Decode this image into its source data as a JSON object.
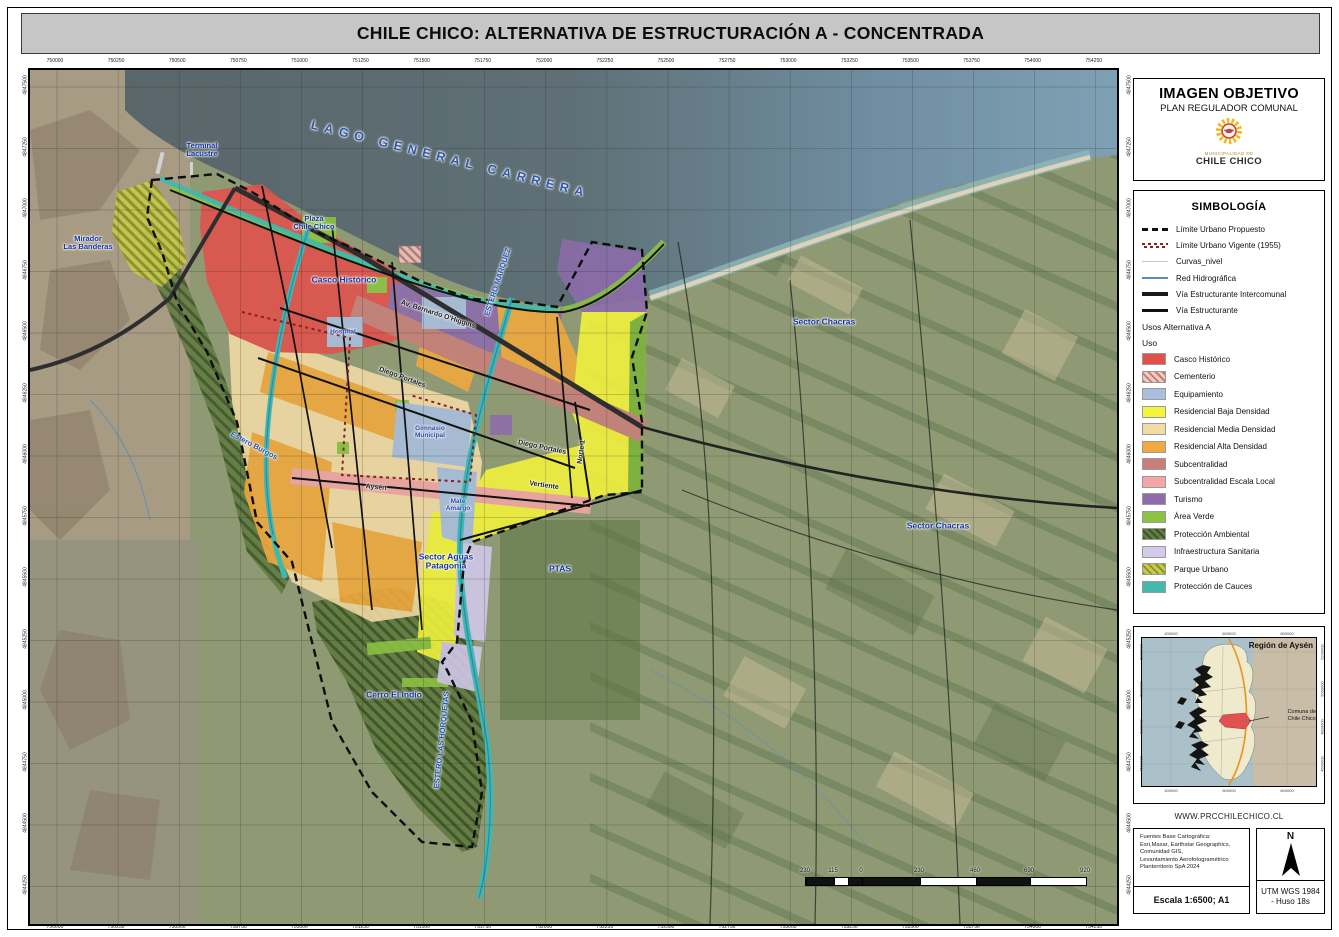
{
  "title": "CHILE CHICO: ALTERNATIVA DE ESTRUCTURACIÓN A - CONCENTRADA",
  "map": {
    "top_ticks": [
      "750000",
      "750250",
      "750500",
      "750750",
      "751000",
      "751250",
      "751500",
      "751750",
      "752000",
      "752250",
      "752500",
      "752750",
      "753000",
      "753250",
      "753500",
      "753750",
      "754000",
      "754250"
    ],
    "bottom_ticks": [
      "750000",
      "750250",
      "750500",
      "750750",
      "751000",
      "751250",
      "751500",
      "751750",
      "752000",
      "752250",
      "752500",
      "752750",
      "753000",
      "753250",
      "753500",
      "753750",
      "754000",
      "754250"
    ],
    "left_ticks": [
      "4847500",
      "4847250",
      "4847000",
      "4846750",
      "4846500",
      "4846250",
      "4846000",
      "4845750",
      "4845500",
      "4845250",
      "4845000",
      "4844750",
      "4844500",
      "4844250"
    ],
    "right_ticks": [
      "4847500",
      "4847250",
      "4847000",
      "4846750",
      "4846500",
      "4846250",
      "4846000",
      "4845750",
      "4845500",
      "4845250",
      "4845000",
      "4844750",
      "4844500",
      "4844250"
    ],
    "scalebar": {
      "labels": [
        "230",
        "115",
        "0",
        "230",
        "460",
        "690",
        "920"
      ]
    },
    "labels": [
      {
        "t": "LAGO GENERAL CARRERA",
        "x": 420,
        "y": 90,
        "r": 14,
        "c": "lake"
      },
      {
        "t": "Terminal\nLacustre",
        "x": 172,
        "y": 80,
        "r": 0,
        "c": "place sm"
      },
      {
        "t": "Mirador\nLas Banderas",
        "x": 58,
        "y": 173,
        "r": 0,
        "c": "place sm"
      },
      {
        "t": "Plaza\nChile Chico",
        "x": 284,
        "y": 153,
        "r": 0,
        "c": "place sm"
      },
      {
        "t": "Casco Histórico",
        "x": 314,
        "y": 210,
        "r": 0,
        "c": "place"
      },
      {
        "t": "Av. Bernardo O'Higgins",
        "x": 408,
        "y": 245,
        "r": 18,
        "c": "street"
      },
      {
        "t": "Diego Portales",
        "x": 372,
        "y": 308,
        "r": 20,
        "c": "street"
      },
      {
        "t": "Diego Portales",
        "x": 512,
        "y": 378,
        "r": 12,
        "c": "street"
      },
      {
        "t": "ESTERO MARQUEZ",
        "x": 468,
        "y": 212,
        "r": -72,
        "c": "water"
      },
      {
        "t": "ESTERO LAS HORQUETAS",
        "x": 412,
        "y": 670,
        "r": -84,
        "c": "water"
      },
      {
        "t": "Estero Burgos",
        "x": 224,
        "y": 376,
        "r": 28,
        "c": "water"
      },
      {
        "t": "Hospital",
        "x": 313,
        "y": 262,
        "r": 0,
        "c": "tinyp"
      },
      {
        "t": "Gimnasio\nMunicipal",
        "x": 400,
        "y": 362,
        "r": 0,
        "c": "tinyp"
      },
      {
        "t": "Mate\nAmargo",
        "x": 428,
        "y": 435,
        "r": 0,
        "c": "tinyp"
      },
      {
        "t": "Aysén",
        "x": 346,
        "y": 418,
        "r": 5,
        "c": "street"
      },
      {
        "t": "Vertiente",
        "x": 514,
        "y": 416,
        "r": 8,
        "c": "street"
      },
      {
        "t": "Norte 1",
        "x": 552,
        "y": 382,
        "r": -82,
        "c": "street"
      },
      {
        "t": "Sector Chacras",
        "x": 794,
        "y": 252,
        "r": 0,
        "c": "place"
      },
      {
        "t": "Sector Chacras",
        "x": 908,
        "y": 456,
        "r": 0,
        "c": "place"
      },
      {
        "t": "Sector Aguas\nPatagonia",
        "x": 416,
        "y": 492,
        "r": 0,
        "c": "place"
      },
      {
        "t": "PTAS",
        "x": 530,
        "y": 499,
        "r": 0,
        "c": "place"
      },
      {
        "t": "Cerro El Indio",
        "x": 364,
        "y": 625,
        "r": 0,
        "c": "place"
      }
    ]
  },
  "panel": {
    "header": {
      "title": "IMAGEN OBJETIVO",
      "subtitle": "PLAN REGULADOR COMUNAL",
      "logo_caption_small": "MUNICIPALIDAD DE",
      "logo_caption": "CHILE CHICO"
    },
    "simbologia": {
      "title": "SIMBOLOGÍA",
      "lines": [
        {
          "label": "Límite Urbano Propuesto",
          "symbol": "dash-black"
        },
        {
          "label": "Límite Urbano Vigente (1955)",
          "symbol": "dash-red"
        },
        {
          "label": "Curvas_nivel",
          "symbol": "thin-gray"
        },
        {
          "label": "Red Hidrográfica",
          "symbol": "blue"
        },
        {
          "label": "Vía Estructurante Intercomunal",
          "symbol": "thick"
        },
        {
          "label": "Vía Estructurante",
          "symbol": "med"
        }
      ],
      "uso_title": "Usos Alternativa A",
      "uso_sub": "Uso",
      "usos": [
        {
          "label": "Casco Histórico",
          "color": "#e2504a"
        },
        {
          "label": "Cementerio",
          "color": "#f0cac4",
          "hatch": "#c47a72"
        },
        {
          "label": "Equipamiento",
          "color": "#aabfe0"
        },
        {
          "label": "Residencial Baja Densidad",
          "color": "#f4f43c"
        },
        {
          "label": "Residencial Media Densidad",
          "color": "#f3dba6"
        },
        {
          "label": "Residencial Alta Densidad",
          "color": "#f2a93e"
        },
        {
          "label": "Subcentralidad",
          "color": "#c97f7b"
        },
        {
          "label": "Subcentralidad Escala Local",
          "color": "#f4a6a4"
        },
        {
          "label": "Turismo",
          "color": "#8e6cab"
        },
        {
          "label": "Área Verde",
          "color": "#8cc344"
        },
        {
          "label": "Protección Ambiental",
          "color": "#607c41",
          "hatch": "#3b5226"
        },
        {
          "label": "Infraestructura Sanitaria",
          "color": "#d3c9ec"
        },
        {
          "label": "Parque Urbano",
          "color": "#c6c94e",
          "hatch": "#8d9226"
        },
        {
          "label": "Protección de Cauces",
          "color": "#45b8ac"
        }
      ]
    },
    "inset": {
      "title": "Región de Aysén",
      "comuna_label": "Comuna de\nChile Chico",
      "top_ticks": [
        "400000",
        "600000",
        "800000"
      ],
      "bottom_ticks": [
        "400000",
        "600000",
        "800000"
      ],
      "left_ticks": [
        "5200000",
        "5000000",
        "4800000",
        "4600000"
      ],
      "right_ticks": [
        "5200000",
        "5000000",
        "4800000",
        "4600000"
      ]
    },
    "website": "WWW.PRCCHILECHICO.CL",
    "credits": {
      "source_lines": [
        "Fuentes Base Cartográfica:",
        "Esri,Maxar, Earthstar Geographics,",
        "Comunidad GIS,",
        "Levantamiento Aerofotogramétrico",
        "Planterritorio SpA 2024"
      ],
      "escala": "Escala 1:6500; A1",
      "north_letter": "N",
      "datum": "UTM WGS 1984\n- Huso 18s"
    }
  }
}
